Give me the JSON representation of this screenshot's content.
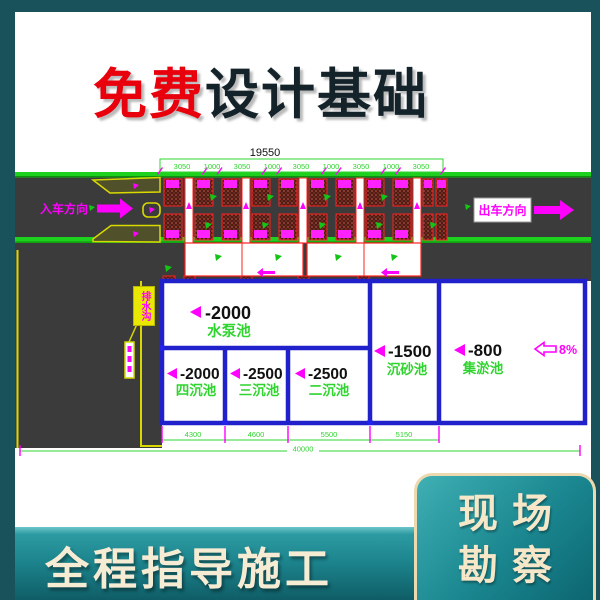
{
  "header": {
    "title_highlight": "免费",
    "title_rest": "设计基础"
  },
  "drawing": {
    "total_dim": "19550",
    "top_dims": [
      "3050",
      "1000",
      "3050",
      "1000",
      "3050",
      "1000",
      "3050",
      "1000",
      "3050"
    ],
    "entry_label": "入车方向",
    "exit_label": "出车方向",
    "drain_callout": "排水沟",
    "slope_label": "8%",
    "pools": {
      "pump": {
        "depth": "-2000",
        "name": "水泵池"
      },
      "fourth": {
        "depth": "-2000",
        "name": "四沉池"
      },
      "third": {
        "depth": "-2500",
        "name": "三沉池"
      },
      "second": {
        "depth": "-2500",
        "name": "二沉池"
      },
      "grit": {
        "depth": "-1500",
        "name": "沉砂池"
      },
      "sludge": {
        "depth": "-800",
        "name": "集淤池"
      }
    },
    "bottom_dims": [
      "4300",
      "4600",
      "5500",
      "5150"
    ],
    "overall_dim": "40000"
  },
  "footer": {
    "slogan": "全程指导施工",
    "badge_line1": "现场",
    "badge_line2": "勘察"
  },
  "colors": {
    "frame_teal": "#19525b",
    "band_teal": "#1d868f",
    "panel_border": "#ecd9b0",
    "cream_text": "#f6ecd4",
    "title_red": "#e8000d",
    "title_dark": "#14222a",
    "cad_green": "#22cc22",
    "cad_magenta": "#ff00ff",
    "cad_blue": "#2121cc",
    "cad_red": "#ff2020",
    "road_gray": "#3b3b3b",
    "brick_red": "#4f1d15",
    "cad_yellow": "#d9d900"
  }
}
